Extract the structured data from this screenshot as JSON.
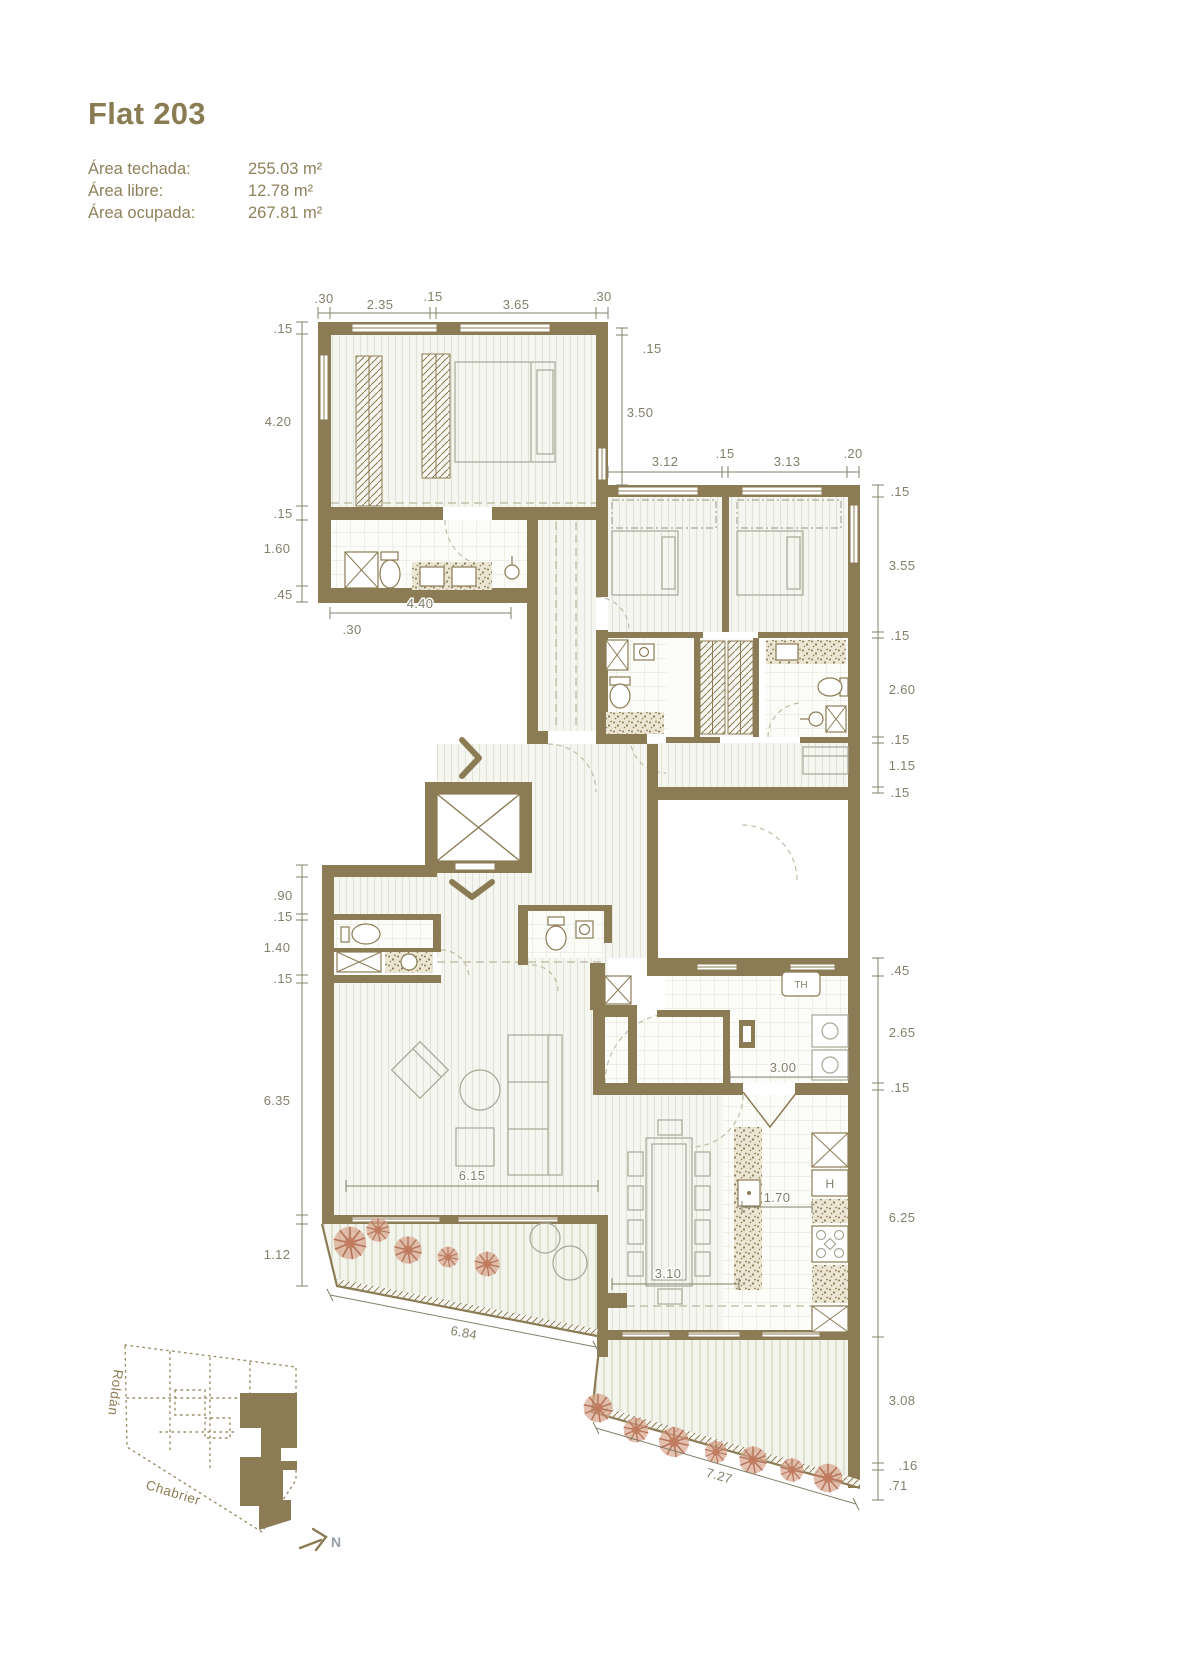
{
  "header": {
    "title": "Flat 203",
    "areas": [
      {
        "label": "Área techada:",
        "value": "255.03 m²"
      },
      {
        "label": "Área libre:",
        "value": "12.78 m²"
      },
      {
        "label": "Área ocupada:",
        "value": "267.81 m²"
      }
    ]
  },
  "plan": {
    "dims": {
      "a_top": [
        ".30",
        "2.35",
        ".15",
        "3.65",
        ".30"
      ],
      "a_left": [
        ".15",
        "4.20",
        ".15",
        "1.60",
        ".45"
      ],
      "a_inner": [
        "3.50",
        ".15",
        "4.40",
        ".30"
      ],
      "b_top": [
        "3.12",
        ".15",
        "3.13",
        ".20"
      ],
      "b_right": [
        ".15",
        "3.55",
        ".15",
        "2.60",
        ".15",
        "1.15",
        ".15"
      ],
      "ll_left": [
        ".90",
        ".15",
        "1.40",
        ".15",
        "6.35",
        "1.12"
      ],
      "interior": [
        "6.15",
        "6.84",
        "3.10",
        "1.70",
        "3.00"
      ],
      "k_right": [
        ".45",
        "2.65",
        ".15",
        "6.25"
      ],
      "terrace": [
        "3.08",
        ".16",
        ".71",
        "7.27"
      ]
    },
    "labels": {
      "water_heater": "TH",
      "oven": "H"
    },
    "north": "N"
  },
  "locator": {
    "street_left": "Roldán",
    "street_bottom": "Chabrier"
  },
  "colors": {
    "wall": "#8c7c55",
    "dim_text": "#83806a",
    "plant": "#bf8166",
    "north_letter": "#97a0ab"
  }
}
